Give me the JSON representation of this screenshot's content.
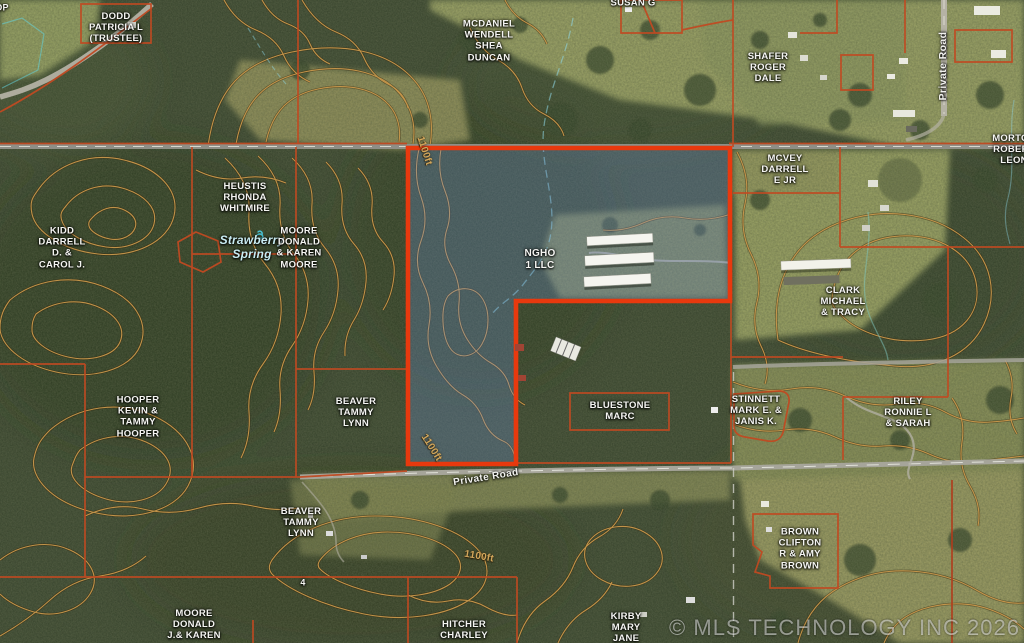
{
  "map": {
    "labels": {
      "op_partial": "OP",
      "dodd": "DODD\nPATRICIA L\n(TRUSTEE)",
      "mcdaniel": "MCDANIEL\nWENDELL\nSHEA\nDUNCAN",
      "susan": "SUSAN G",
      "shafer": "SHAFER\nROGER\nDALE",
      "mcvey": "MCVEY\nDARRELL\nE JR",
      "morton": "MORTON\nROBERT\nLEON",
      "heustis": "HEUSTIS\nRHONDA\nWHITMIRE",
      "kidd": "KIDD\nDARRELL\nD. &\nCAROL J.",
      "moore_upper": "MOORE\nDONALD\n& KAREN\nMOORE",
      "ngho": "NGHO\n1 LLC",
      "clark": "CLARK\nMICHAEL\n& TRACY",
      "hooper": "HOOPER\nKEVIN &\nTAMMY\nHOOPER",
      "beaver_upper": "BEAVER\nTAMMY\nLYNN",
      "bluestone": "BLUESTONE\nMARC",
      "stinnett": "STINNETT\nMARK E. &\nJANIS K.",
      "riley": "RILEY\nRONNIE L\n& SARAH",
      "beaver_lower": "BEAVER\nTAMMY\nLYNN",
      "brown": "BROWN\nCLIFTON\nR & AMY\nBROWN",
      "moore_lower": "MOORE\nDONALD\nJ.& KAREN",
      "hitcher": "HITCHER\nCHARLEY",
      "kirby": "KIRBY\nMARY\nJANE",
      "section_number": "4"
    },
    "annotations": {
      "spring": "Strawberry\nSpring",
      "spring_icon": "spring-icon",
      "contour_top": "1100ft",
      "contour_mid": "1100ft",
      "contour_bottom": "1100ft",
      "road_vertical": "Private Road",
      "road_horizontal": "Private Road",
      "watermark": "© MLS TECHNOLOGY INC 2026"
    },
    "subject_parcel": {
      "owner": "NGHO 1 LLC"
    },
    "colors": {
      "subject_outline": "#e8390e",
      "parcel_line": "#c04a22",
      "contour": "#c9984c",
      "contour_casing": "#33270e",
      "road_fill": "#a6a59a",
      "road_dash": "#e8e8e0",
      "stream": "#8fd8e8",
      "label_text": "#f5f5f2",
      "spring_text": "#c9ecf2",
      "spring_icon_color": "#49c2d4",
      "contour_label": "#d2a75c",
      "selection_tint": "rgba(108,142,208,0.30)",
      "watermark_color": "rgba(255,255,255,0.5)"
    }
  }
}
